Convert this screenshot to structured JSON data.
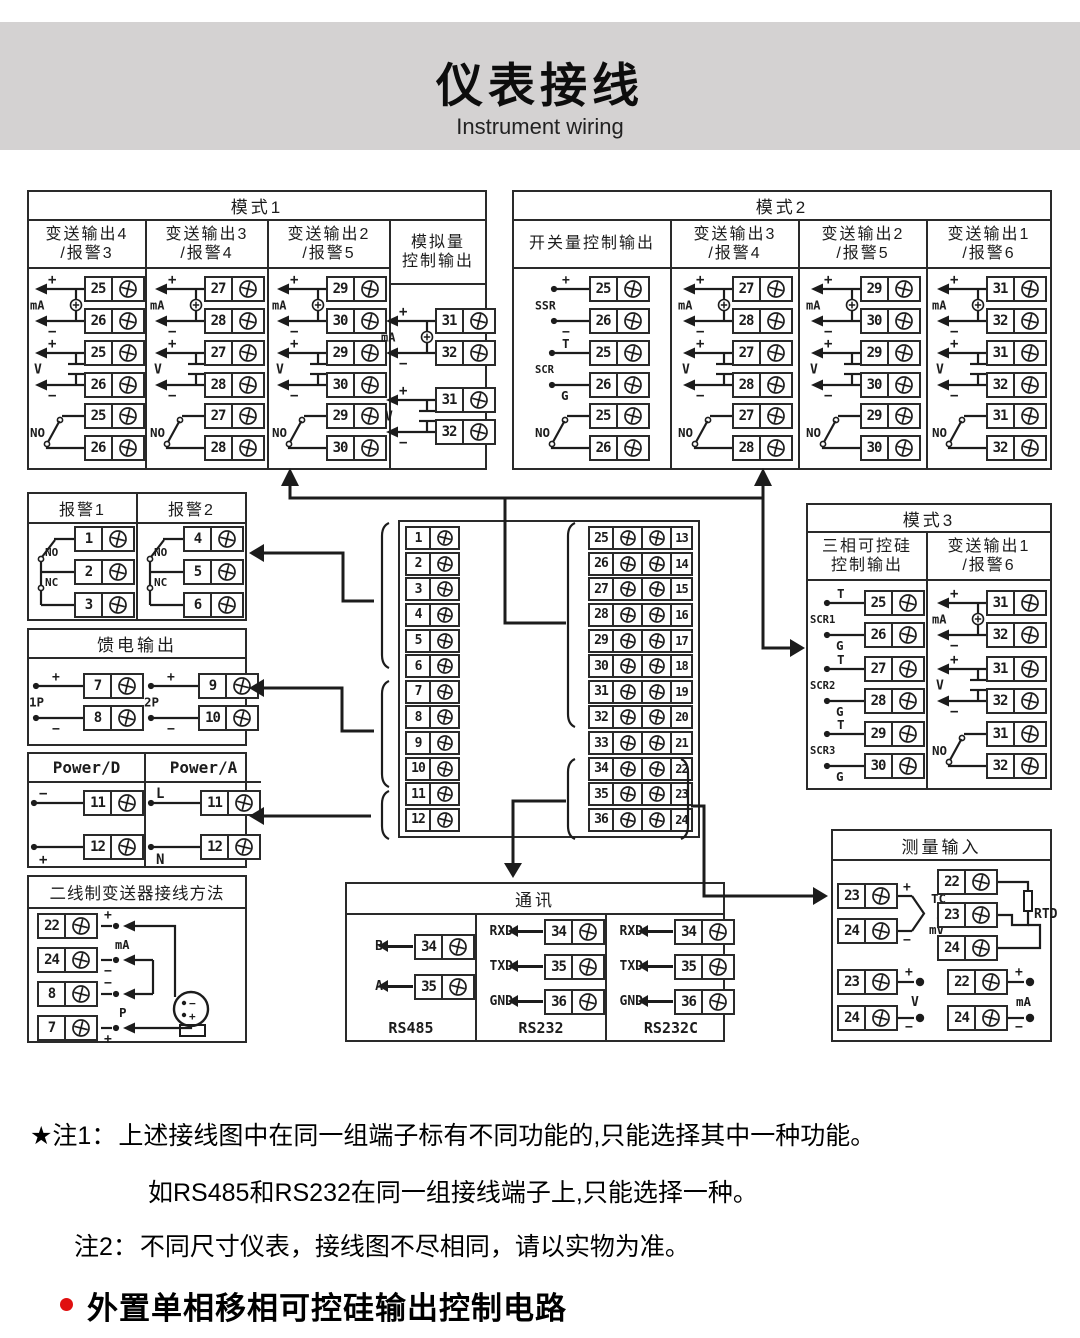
{
  "header": {
    "title": "仪表接线",
    "subtitle": "Instrument wiring"
  },
  "mode1": {
    "title": "模式1",
    "columns": [
      {
        "title": "变送输出4",
        "title2": "/报警3",
        "groups": [
          {
            "type": "mA",
            "label": "mA",
            "top": "+",
            "bot": "−",
            "t": [
              "25",
              "26"
            ]
          },
          {
            "type": "V",
            "label": "V",
            "top": "+",
            "bot": "−",
            "t": [
              "25",
              "26"
            ]
          },
          {
            "type": "NO",
            "label": "NO",
            "t": [
              "25",
              "26"
            ]
          }
        ]
      },
      {
        "title": "变送输出3",
        "title2": "/报警4",
        "groups": [
          {
            "type": "mA",
            "label": "mA",
            "top": "+",
            "bot": "−",
            "t": [
              "27",
              "28"
            ]
          },
          {
            "type": "V",
            "label": "V",
            "top": "+",
            "bot": "−",
            "t": [
              "27",
              "28"
            ]
          },
          {
            "type": "NO",
            "label": "NO",
            "t": [
              "27",
              "28"
            ]
          }
        ]
      },
      {
        "title": "变送输出2",
        "title2": "/报警5",
        "groups": [
          {
            "type": "mA",
            "label": "mA",
            "top": "+",
            "bot": "−",
            "t": [
              "29",
              "30"
            ]
          },
          {
            "type": "V",
            "label": "V",
            "top": "+",
            "bot": "−",
            "t": [
              "29",
              "30"
            ]
          },
          {
            "type": "NO",
            "label": "NO",
            "t": [
              "29",
              "30"
            ]
          }
        ]
      },
      {
        "title": "模拟量",
        "title2": "控制输出",
        "groups": [
          {
            "type": "mA",
            "label": "mA",
            "top": "+",
            "bot": "−",
            "t": [
              "31",
              "32"
            ]
          },
          {
            "type": "V",
            "label": "V",
            "top": "+",
            "bot": "−",
            "t": [
              "31",
              "32"
            ]
          }
        ]
      }
    ]
  },
  "mode2": {
    "title": "模式2",
    "columns": [
      {
        "title": "开关量控制输出",
        "title2": "",
        "groups": [
          {
            "type": "SSR",
            "label": "SSR",
            "top": "+",
            "bot": "−",
            "t": [
              "25",
              "26"
            ]
          },
          {
            "type": "SCR",
            "label": "SCR",
            "top": "T",
            "bot": "G",
            "t": [
              "25",
              "26"
            ]
          },
          {
            "type": "NO",
            "label": "NO",
            "t": [
              "25",
              "26"
            ]
          }
        ]
      },
      {
        "title": "变送输出3",
        "title2": "/报警4",
        "groups": [
          {
            "type": "mA",
            "label": "mA",
            "top": "+",
            "bot": "−",
            "t": [
              "27",
              "28"
            ]
          },
          {
            "type": "V",
            "label": "V",
            "top": "+",
            "bot": "−",
            "t": [
              "27",
              "28"
            ]
          },
          {
            "type": "NO",
            "label": "NO",
            "t": [
              "27",
              "28"
            ]
          }
        ]
      },
      {
        "title": "变送输出2",
        "title2": "/报警5",
        "groups": [
          {
            "type": "mA",
            "label": "mA",
            "top": "+",
            "bot": "−",
            "t": [
              "29",
              "30"
            ]
          },
          {
            "type": "V",
            "label": "V",
            "top": "+",
            "bot": "−",
            "t": [
              "29",
              "30"
            ]
          },
          {
            "type": "NO",
            "label": "NO",
            "t": [
              "29",
              "30"
            ]
          }
        ]
      },
      {
        "title": "变送输出1",
        "title2": "/报警6",
        "groups": [
          {
            "type": "mA",
            "label": "mA",
            "top": "+",
            "bot": "−",
            "t": [
              "31",
              "32"
            ]
          },
          {
            "type": "V",
            "label": "V",
            "top": "+",
            "bot": "−",
            "t": [
              "31",
              "32"
            ]
          },
          {
            "type": "NO",
            "label": "NO",
            "t": [
              "31",
              "32"
            ]
          }
        ]
      }
    ]
  },
  "mode3": {
    "title": "模式3",
    "columns": [
      {
        "title": "三相可控硅",
        "title2": "控制输出",
        "groups": [
          {
            "type": "SCR",
            "label": "SCR1",
            "top": "T",
            "bot": "G",
            "t": [
              "25",
              "26"
            ]
          },
          {
            "type": "SCR",
            "label": "SCR2",
            "top": "T",
            "bot": "G",
            "t": [
              "27",
              "28"
            ]
          },
          {
            "type": "SCR",
            "label": "SCR3",
            "top": "T",
            "bot": "G",
            "t": [
              "29",
              "30"
            ]
          }
        ]
      },
      {
        "title": "变送输出1",
        "title2": "/报警6",
        "groups": [
          {
            "type": "mA",
            "label": "mA",
            "top": "+",
            "bot": "−",
            "t": [
              "31",
              "32"
            ]
          },
          {
            "type": "V",
            "label": "V",
            "top": "+",
            "bot": "−",
            "t": [
              "31",
              "32"
            ]
          },
          {
            "type": "NO",
            "label": "NO",
            "t": [
              "31",
              "32"
            ]
          }
        ]
      }
    ]
  },
  "alarm": {
    "cols": [
      {
        "title": "报警1",
        "no": "NO",
        "nc": "NC",
        "t": [
          "1",
          "2",
          "3"
        ]
      },
      {
        "title": "报警2",
        "no": "NO",
        "nc": "NC",
        "t": [
          "4",
          "5",
          "6"
        ]
      }
    ]
  },
  "feed": {
    "title": "馈电输出",
    "groups": [
      {
        "type": "FEED",
        "label": "1P",
        "top": "+",
        "bot": "−",
        "t": [
          "7",
          "8"
        ]
      },
      {
        "type": "FEED",
        "label": "2P",
        "top": "+",
        "bot": "−",
        "t": [
          "9",
          "10"
        ]
      }
    ]
  },
  "power": {
    "cols": [
      {
        "title": "Power/D",
        "group": {
          "type": "PWR",
          "top": "−",
          "bot": "+",
          "t": [
            "11",
            "12"
          ]
        }
      },
      {
        "title": "Power/A",
        "group": {
          "type": "PWR",
          "top": "L",
          "bot": "N",
          "t": [
            "11",
            "12"
          ]
        }
      }
    ]
  },
  "twowire": {
    "title": "二线制变送器接线方法",
    "rows": [
      {
        "t": "22",
        "sign": "+",
        "pos": "above"
      },
      {
        "t": "24",
        "sign": "−",
        "pos": "below"
      },
      {
        "t": "8",
        "sign": "−",
        "pos": "above"
      },
      {
        "t": "7",
        "sign": "+",
        "pos": "below"
      }
    ],
    "mid_label1": "mA",
    "mid_label2": "P",
    "tx_minus": "−",
    "tx_plus": "+"
  },
  "center": {
    "left": [
      "1",
      "2",
      "3",
      "4",
      "5",
      "6",
      "7",
      "8",
      "9",
      "10",
      "11",
      "12"
    ],
    "mid": [
      "25",
      "26",
      "27",
      "28",
      "29",
      "30",
      "31",
      "32",
      "33",
      "34",
      "35",
      "36"
    ],
    "right": [
      "13",
      "14",
      "15",
      "16",
      "17",
      "18",
      "19",
      "20",
      "21",
      "22",
      "23",
      "24"
    ]
  },
  "comm": {
    "title": "通讯",
    "sections": [
      {
        "name": "RS485",
        "rows": [
          {
            "label": "B",
            "t": "34"
          },
          {
            "label": "A",
            "t": "35"
          }
        ]
      },
      {
        "name": "RS232",
        "rows": [
          {
            "label": "RXD",
            "t": "34"
          },
          {
            "label": "TXD",
            "t": "35"
          },
          {
            "label": "GND",
            "t": "36"
          }
        ]
      },
      {
        "name": "RS232C",
        "rows": [
          {
            "label": "RXD",
            "t": "34"
          },
          {
            "label": "TXD",
            "t": "35"
          },
          {
            "label": "GND",
            "t": "36"
          }
        ]
      }
    ]
  },
  "measure": {
    "title": "测量输入",
    "tc": {
      "l1": "TC",
      "l2": "/",
      "l3": "mV",
      "top": "+",
      "bot": "−",
      "t": [
        "23",
        "24"
      ]
    },
    "rtd": {
      "label": "RTD",
      "t": [
        "22",
        "23",
        "24"
      ]
    },
    "v": {
      "label": "V",
      "top": "+",
      "bot": "−",
      "t": [
        "23",
        "24"
      ]
    },
    "ma": {
      "label": "mA",
      "top": "+",
      "bot": "−",
      "t": [
        "22",
        "24"
      ]
    }
  },
  "notes": {
    "n1p": "★注1：",
    "n1": "上述接线图中在同一组端子标有不同功能的,只能选择其中一种功能。",
    "n2": "如RS485和RS232在同一组接线端子上,只能选择一种。",
    "n3p": "注2：",
    "n3": "不同尺寸仪表，接线图不尽相同，请以实物为准。"
  },
  "bullet": {
    "text": "外置单相移相可控硅输出控制电路"
  },
  "colors": {
    "line": "#1c1c1c",
    "banner": "#d4d2d2",
    "bullet_dot": "#e01010"
  }
}
